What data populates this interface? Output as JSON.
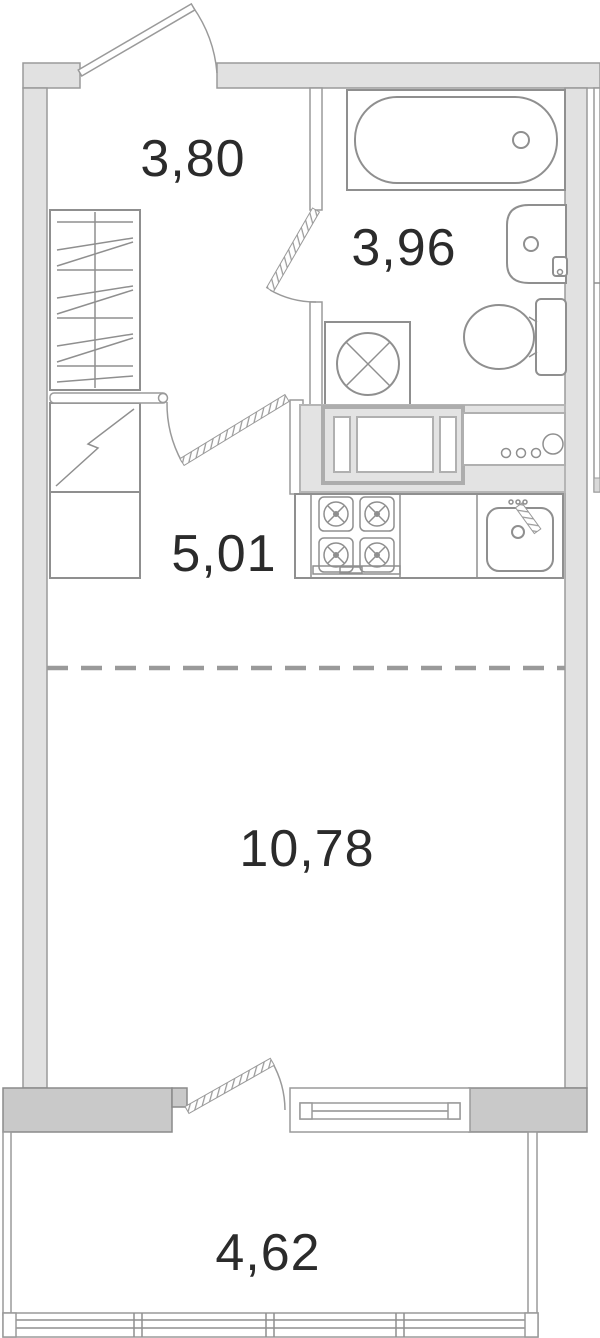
{
  "areas": {
    "hallway": "3,80",
    "bathroom": "3,96",
    "kitchen": "5,01",
    "living_room": "10,78",
    "balcony": "4,62"
  },
  "colors": {
    "background": "#ffffff",
    "wall_fill": "#e1e1e1",
    "wall_dark_fill": "#c9c9c9",
    "line": "#8f8f8f",
    "line_light": "#b0b0b0",
    "text": "#2b2b2b"
  }
}
